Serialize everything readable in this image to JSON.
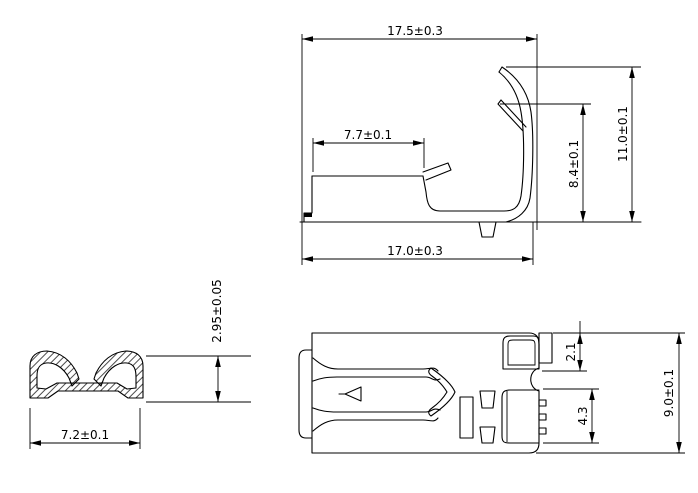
{
  "drawing": {
    "background_color": "#ffffff",
    "line_color": "#000000",
    "side_view": {
      "dim_overall_width_top": "17.5±0.3",
      "dim_barrel_length": "7.7±0.1",
      "dim_overall_width_bottom": "17.0±0.3",
      "dim_spring_height": "8.4±0.1",
      "dim_overall_height": "11.0±0.1"
    },
    "section_view": {
      "dim_height": "2.95±0.05",
      "dim_width": "7.2±0.1"
    },
    "plan_view": {
      "dim_tab_height": "2.1",
      "dim_contact_height": "4.3",
      "dim_overall_height": "9.0±0.1"
    }
  }
}
